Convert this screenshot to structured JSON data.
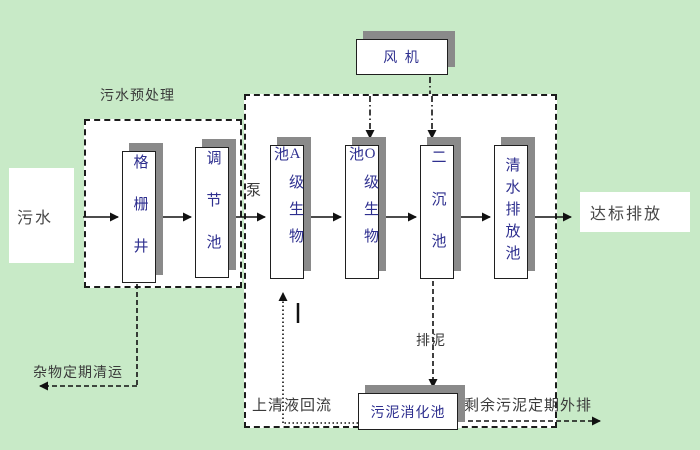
{
  "diagram_title": "wastewater-treatment-process-flow",
  "colors": {
    "background": "#c8eac7",
    "node_text": "#2e2f8f",
    "label_text": "#3a3a3a",
    "shadow": "#8a8a8a",
    "line": "#1c1c1c"
  },
  "nodes": {
    "influent": "污水",
    "grid_well": "格栅井",
    "regulating_tank": "调节池",
    "a_bio_tank": "A级生物池",
    "o_bio_tank": "O级生物池",
    "secondary_sedimentation_tank": "二沉池",
    "clear_water_discharge_tank": "清水排放池",
    "fan": "风 机",
    "sludge_digestion_tank": "污泥消化池",
    "effluent": "达标排放"
  },
  "labels": {
    "pretreatment_zone": "污水预处理",
    "pump": "泵",
    "debris_removal": "杂物定期清运",
    "supernatant_return": "上清液回流",
    "sludge_drain": "排泥",
    "excess_sludge_out": "剩余污泥定期外排"
  }
}
